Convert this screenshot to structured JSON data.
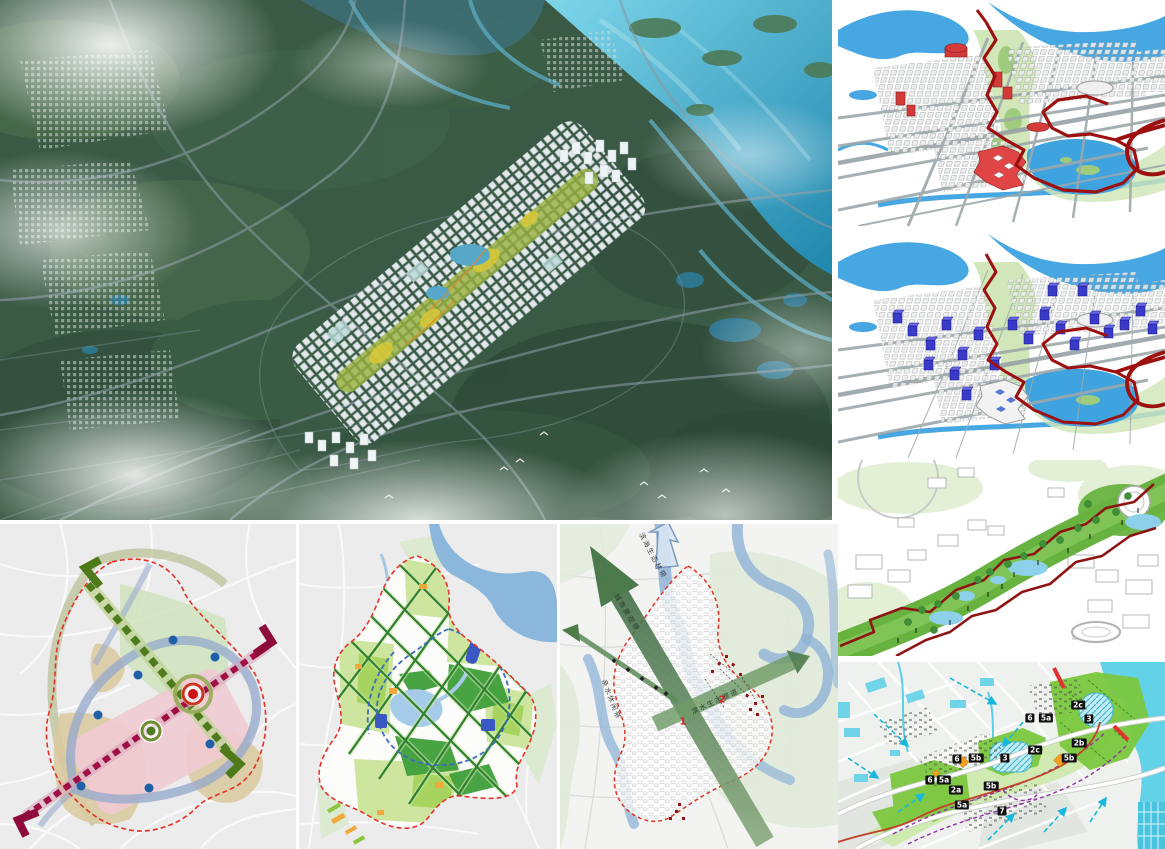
{
  "colors": {
    "sea_blue": "#3fb0d8",
    "forest_green": "#3a5a45",
    "diagram_water_blue": "#47a7e2",
    "plan_water_cyan": "#5ad0e8",
    "route_red": "#9c1010",
    "landmark_red": "#d33b3b",
    "landmark_blue": "#3a3ac8",
    "corridor_green": "#68b340",
    "parcel_green": "#7cc83f",
    "boundary_red_dash": "#e53126",
    "axis_green": "#4f7a1d",
    "axis_crimson": "#a00e44",
    "node_blue": "#2060a8",
    "flow_arrow_cyan": "#18b8dc",
    "big_arrow_green": "#46704a",
    "tag_background": "#101010"
  },
  "p4_tags": [
    "6",
    "5a",
    "2c",
    "3",
    "2c",
    "2b",
    "6",
    "5b",
    "3",
    "5b",
    "6",
    "5a",
    "2a",
    "5b",
    "5a",
    "7"
  ],
  "b3_numbers": [
    "1",
    "2"
  ],
  "b3_arrow_labels": {
    "coastal_belt": "滨海生态林带",
    "city_axis": "城市景观带",
    "waterfront": "亲水休闲带",
    "eco_corridor": "滨水生态廊道"
  }
}
